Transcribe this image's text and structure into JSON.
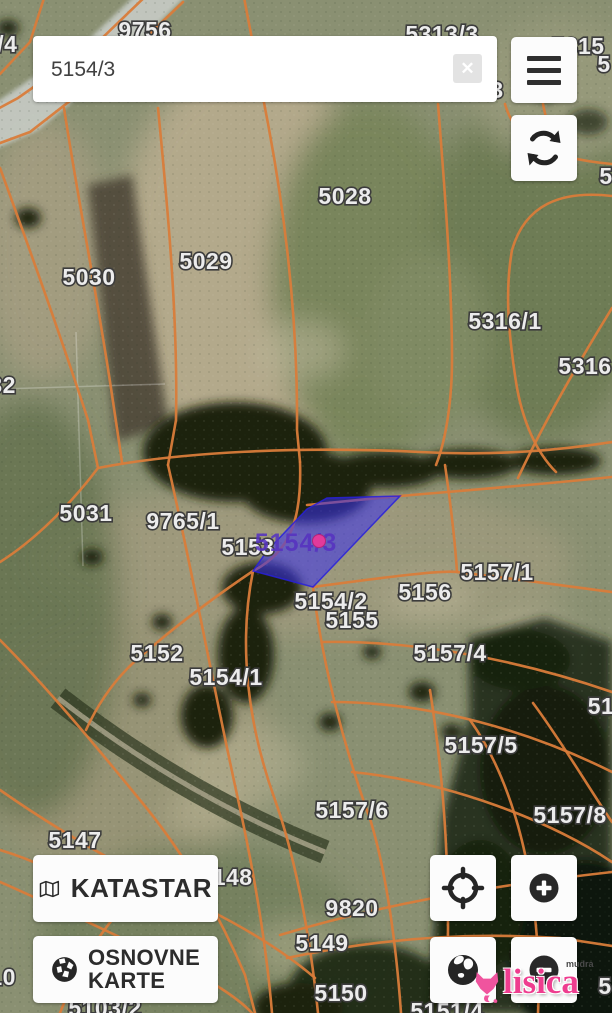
{
  "search": {
    "value": "5154/3",
    "clear_glyph": "✕"
  },
  "buttons": {
    "katastar": {
      "label": "KATASTAR"
    },
    "osnovne_karte": {
      "line1": "OSNOVNE",
      "line2": "KARTE"
    }
  },
  "watermark": {
    "brand": "lisica",
    "prefix": "mudra"
  },
  "map": {
    "selected_parcel": {
      "label": "5154/3",
      "points": "307,509 327,498 400,496 313,587 253,571 267,551",
      "label_x": 296,
      "label_y": 543,
      "marker_x": 319,
      "marker_y": 541
    },
    "colors": {
      "parcel_line": "#d97c3a",
      "selection_fill": "rgba(57,48,238,0.55)",
      "selection_label": "#5633c0",
      "marker": "#e33a9b",
      "watermark_pink": "#ee3d8f"
    },
    "labels": [
      {
        "t": "9756",
        "x": 145,
        "y": 30
      },
      {
        "t": "05/4",
        "x": -6,
        "y": 44,
        "a": "start"
      },
      {
        "t": "5313/3",
        "x": 442,
        "y": 34
      },
      {
        "t": "5315",
        "x": 578,
        "y": 46,
        "a": "start"
      },
      {
        "t": "5",
        "x": 604,
        "y": 64,
        "a": "start"
      },
      {
        "t": "3",
        "x": 497,
        "y": 90,
        "a": "start"
      },
      {
        "t": "5",
        "x": 606,
        "y": 176,
        "a": "start"
      },
      {
        "t": "5028",
        "x": 345,
        "y": 196
      },
      {
        "t": "5029",
        "x": 206,
        "y": 261
      },
      {
        "t": "5030",
        "x": 89,
        "y": 277
      },
      {
        "t": "5316/1",
        "x": 505,
        "y": 321
      },
      {
        "t": "5316",
        "x": 585,
        "y": 366,
        "a": "start"
      },
      {
        "t": "032",
        "x": -4,
        "y": 385,
        "a": "start"
      },
      {
        "t": "5031",
        "x": 86,
        "y": 513
      },
      {
        "t": "9765/1",
        "x": 183,
        "y": 521
      },
      {
        "t": "5153",
        "x": 248,
        "y": 547
      },
      {
        "t": "5157/1",
        "x": 497,
        "y": 572
      },
      {
        "t": "5156",
        "x": 425,
        "y": 592
      },
      {
        "t": "5154/2",
        "x": 331,
        "y": 601
      },
      {
        "t": "5155",
        "x": 352,
        "y": 620
      },
      {
        "t": "5152",
        "x": 157,
        "y": 653
      },
      {
        "t": "5157/4",
        "x": 450,
        "y": 653
      },
      {
        "t": "5154/1",
        "x": 226,
        "y": 677
      },
      {
        "t": "51",
        "x": 601,
        "y": 706,
        "a": "start"
      },
      {
        "t": "5157/5",
        "x": 481,
        "y": 745
      },
      {
        "t": "5157/6",
        "x": 352,
        "y": 810
      },
      {
        "t": "5157/8",
        "x": 570,
        "y": 815
      },
      {
        "t": "5147",
        "x": 75,
        "y": 840
      },
      {
        "t": "5148",
        "x": 226,
        "y": 877
      },
      {
        "t": "9820",
        "x": 352,
        "y": 908
      },
      {
        "t": "5149",
        "x": 322,
        "y": 943
      },
      {
        "t": "5150",
        "x": 341,
        "y": 993
      },
      {
        "t": "510",
        "x": -4,
        "y": 977,
        "a": "start"
      },
      {
        "t": "5103/2",
        "x": 105,
        "y": 1008
      },
      {
        "t": "5151/4",
        "x": 447,
        "y": 1011
      },
      {
        "t": "5",
        "x": 605,
        "y": 986,
        "a": "start"
      }
    ]
  }
}
